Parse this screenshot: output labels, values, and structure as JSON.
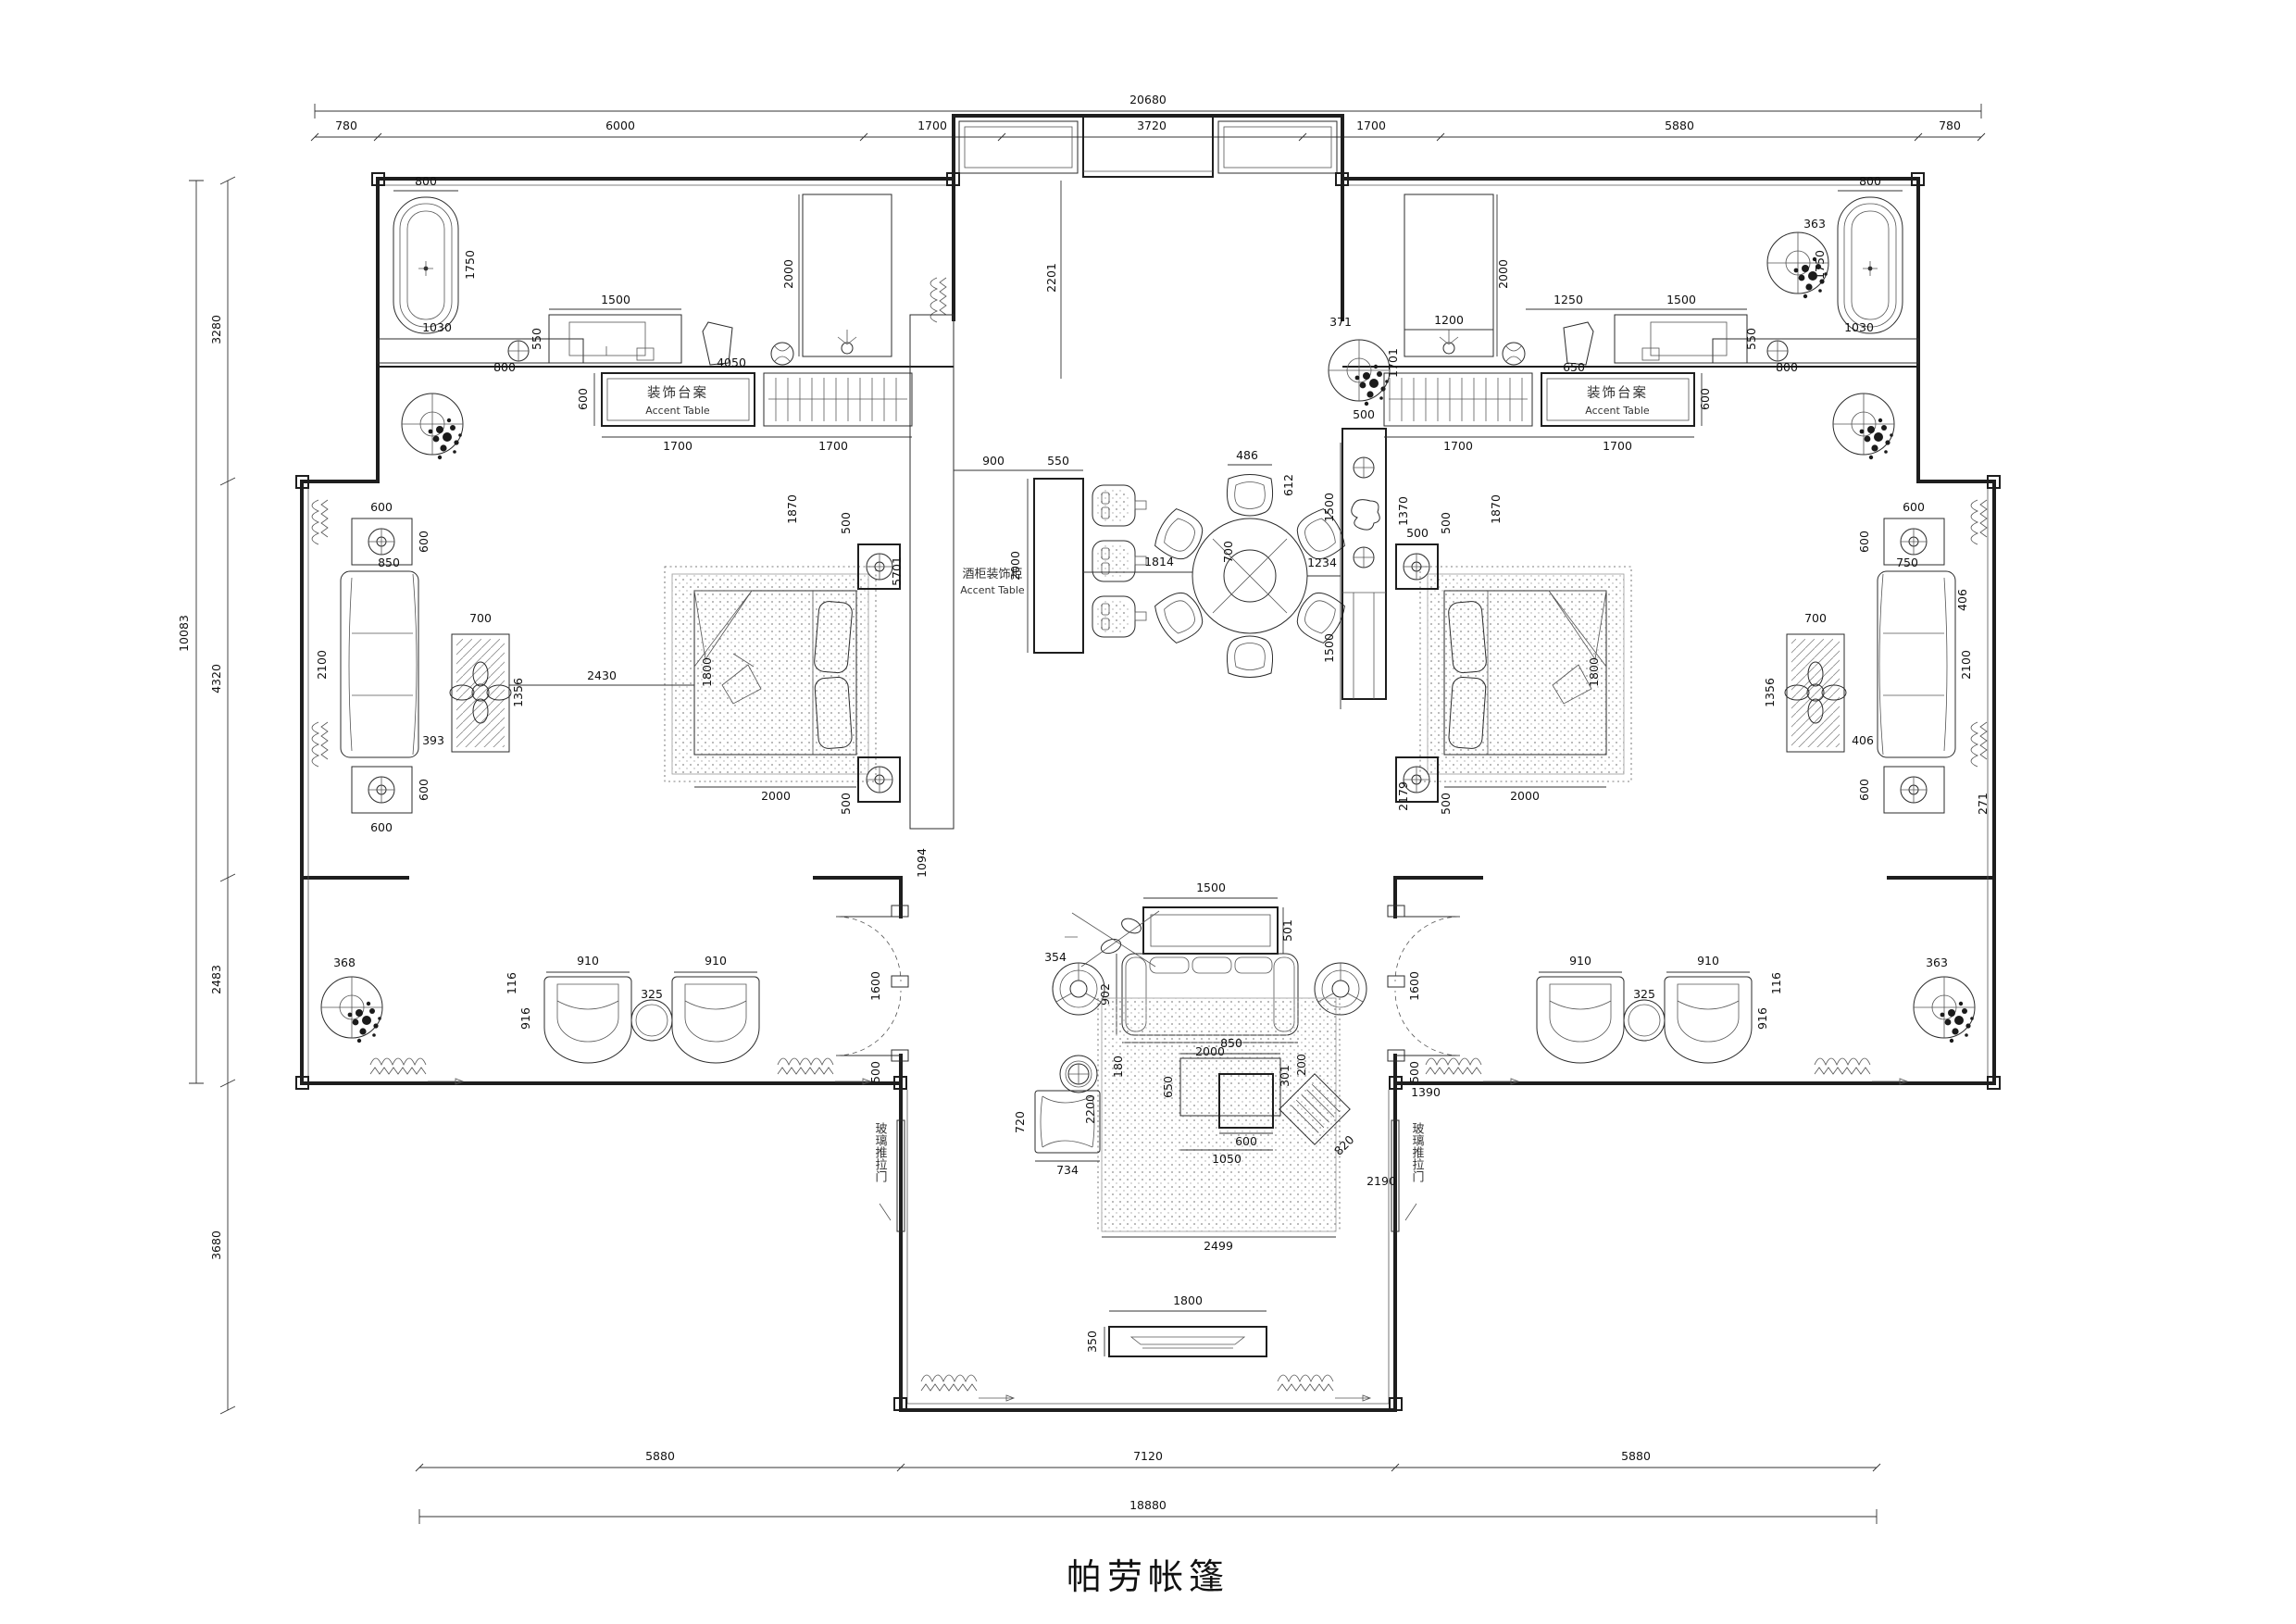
{
  "title": "帕劳帐篷",
  "labels": {
    "accent_cn": "装饰台案",
    "accent_en": "Accent Table",
    "wine_cn": "酒柜装饰柜",
    "wine_en": "Accent Table",
    "glass_door": "玻璃推拉门"
  },
  "dims": {
    "top_total": "20680",
    "top": [
      "780",
      "6000",
      "1700",
      "3720",
      "1700",
      "5880",
      "780"
    ],
    "bottom": [
      "5880",
      "7120",
      "5880"
    ],
    "bottom_total": "18880",
    "left": [
      "3280",
      "4320",
      "2483",
      "3680"
    ],
    "left_total": "10083"
  },
  "v": {
    "800": "800",
    "1750": "1750",
    "1030": "1030",
    "1500": "1500",
    "550": "550",
    "4050": "4050",
    "600": "600",
    "1700": "1700",
    "2000": "2000",
    "1200": "1200",
    "1250": "1250",
    "650": "650",
    "363": "363",
    "368": "368",
    "371": "371",
    "1870": "1870",
    "1370": "1370",
    "500": "500",
    "900": "900",
    "5701": "5701",
    "2201": "2201",
    "1814": "1814",
    "486": "486",
    "612": "612",
    "700": "700",
    "1234": "1234",
    "850": "850",
    "2100": "2100",
    "393": "393",
    "1356": "1356",
    "2430": "2430",
    "1094": "1094",
    "406": "406",
    "750": "750",
    "271": "271",
    "910": "910",
    "325": "325",
    "916": "916",
    "116": "116",
    "1600": "1600",
    "501": "501",
    "354": "354",
    "902": "902",
    "301": "301",
    "200": "200",
    "180": "180",
    "2200": "2200",
    "720": "720",
    "734": "734",
    "2499": "2499",
    "1050": "1050",
    "820": "820",
    "2190": "2190",
    "1390": "1390",
    "1800": "1800",
    "350": "350",
    "2179": "2179",
    "1701": "1701"
  }
}
